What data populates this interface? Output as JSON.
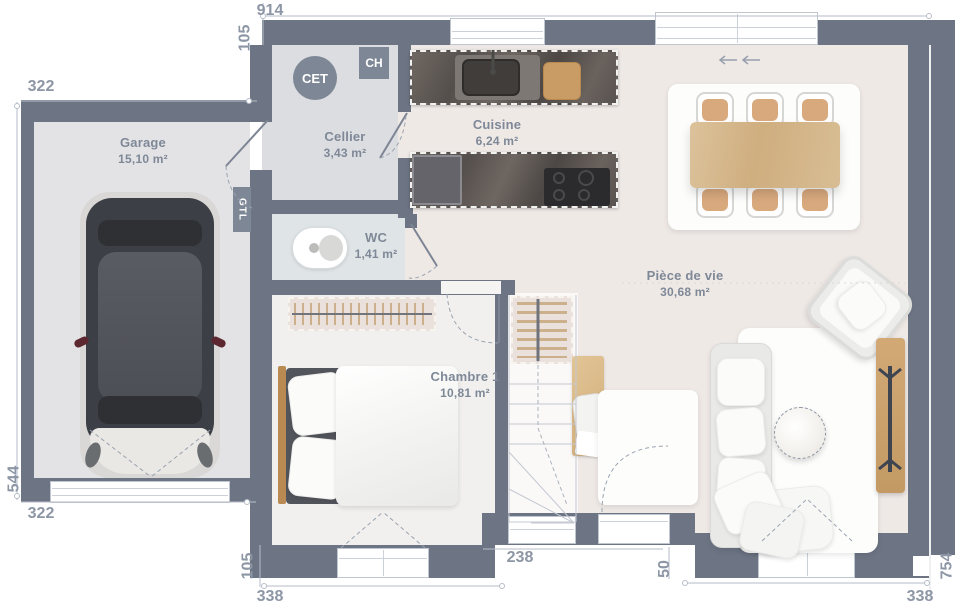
{
  "plan_title": "House ground-floor plan",
  "rooms": [
    {
      "name": "Garage",
      "area": "15,10 m²"
    },
    {
      "name": "Cellier",
      "area": "3,43 m²"
    },
    {
      "name": "WC",
      "area": "1,41 m²"
    },
    {
      "name": "Cuisine",
      "area": "6,24 m²"
    },
    {
      "name": "Chambre 1",
      "area": "10,81 m²"
    },
    {
      "name": "Pièce de vie",
      "area": "30,68 m²"
    }
  ],
  "equipment": {
    "water_heater": "CET",
    "boiler": "CH",
    "electrical_panel": "GTL"
  },
  "dimensions": {
    "top_width": "914",
    "top_offset": "105",
    "garage_width_top": "322",
    "left_height": "544",
    "garage_width_bottom": "322",
    "bottom_offset": "105",
    "bottom_chambre_width": "338",
    "bottom_middle_width": "238",
    "entrance_width": "50",
    "right_height": "754",
    "bottom_living_width": "338"
  },
  "colors": {
    "wall": "#6d7585",
    "garage_floor": "#e3e3e5",
    "cellier_floor": "#dcdde0",
    "wc_floor": "#dfe4e6",
    "chambre_floor": "#f1f0ee",
    "main_floor": "#efe9e6",
    "wood": "#d7b98e",
    "counter": "#5f5855",
    "dimension_text": "#8d96a5",
    "label_text": "#7e8897"
  }
}
